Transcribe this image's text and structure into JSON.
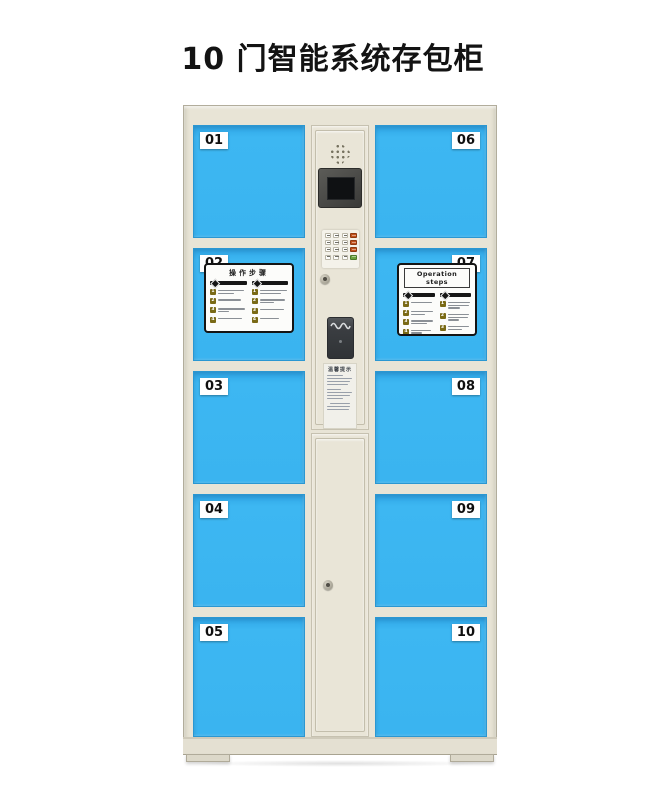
{
  "title": "10 门智能系统存包柜",
  "locker": {
    "doors": [
      {
        "number": "01"
      },
      {
        "number": "02"
      },
      {
        "number": "03"
      },
      {
        "number": "04"
      },
      {
        "number": "05"
      },
      {
        "number": "06"
      },
      {
        "number": "07"
      },
      {
        "number": "08"
      },
      {
        "number": "09"
      },
      {
        "number": "10"
      }
    ],
    "sticker_cn": {
      "title": "操作步骤",
      "left_steps": [
        "1",
        "2",
        "3",
        "4"
      ],
      "right_steps": [
        "1",
        "2",
        "3",
        "4"
      ]
    },
    "sticker_en": {
      "title": "Operation steps",
      "left_steps": [
        "1",
        "2",
        "3",
        "4"
      ],
      "right_steps": [
        "1",
        "2",
        "3"
      ]
    },
    "notice_label": {
      "title": "温馨提示"
    },
    "colors": {
      "door_blue": "#3ab4f0",
      "cabinet_body": "#e8e4d6",
      "keypad_red": "#c2511c",
      "keypad_green": "#69a23e",
      "step_number_yellow": "#7a6a16",
      "title_text": "#131313"
    }
  }
}
